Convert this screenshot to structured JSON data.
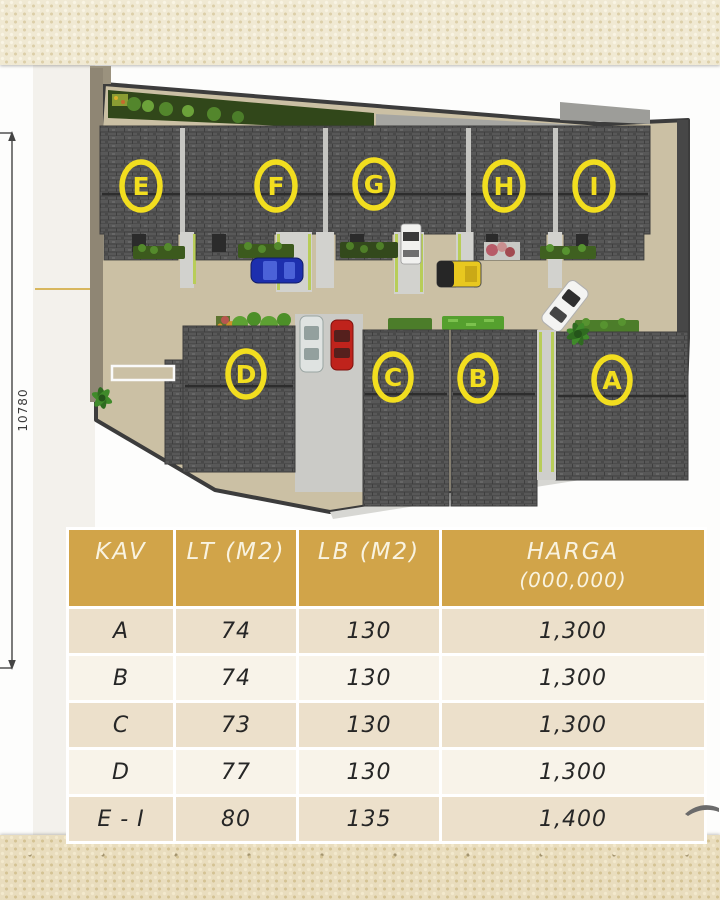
{
  "slide": {
    "dimension_label": "10780"
  },
  "site_plan": {
    "top_units": [
      "E",
      "F",
      "G",
      "H",
      "I"
    ],
    "bottom_units": [
      "D",
      "C",
      "B",
      "A"
    ],
    "unit_label_color": "#F2DE1F"
  },
  "table": {
    "header": {
      "kav": "KAV",
      "lt": "LT (M2)",
      "lb": "LB (M2)",
      "harga_line1": "HARGA",
      "harga_line2": "(000,000)"
    },
    "rows": [
      {
        "kav": "A",
        "lt": "74",
        "lb": "130",
        "harga": "1,300"
      },
      {
        "kav": "B",
        "lt": "74",
        "lb": "130",
        "harga": "1,300"
      },
      {
        "kav": "C",
        "lt": "73",
        "lb": "130",
        "harga": "1,300"
      },
      {
        "kav": "D",
        "lt": "77",
        "lb": "130",
        "harga": "1,300"
      },
      {
        "kav": "E - I",
        "lt": "80",
        "lb": "135",
        "harga": "1,400"
      }
    ],
    "header_bg": "#D1A449",
    "row_bg_dark": "#ECE0CB",
    "row_bg_light": "#F8F3E9",
    "grid_color": "#FFFFFF"
  }
}
